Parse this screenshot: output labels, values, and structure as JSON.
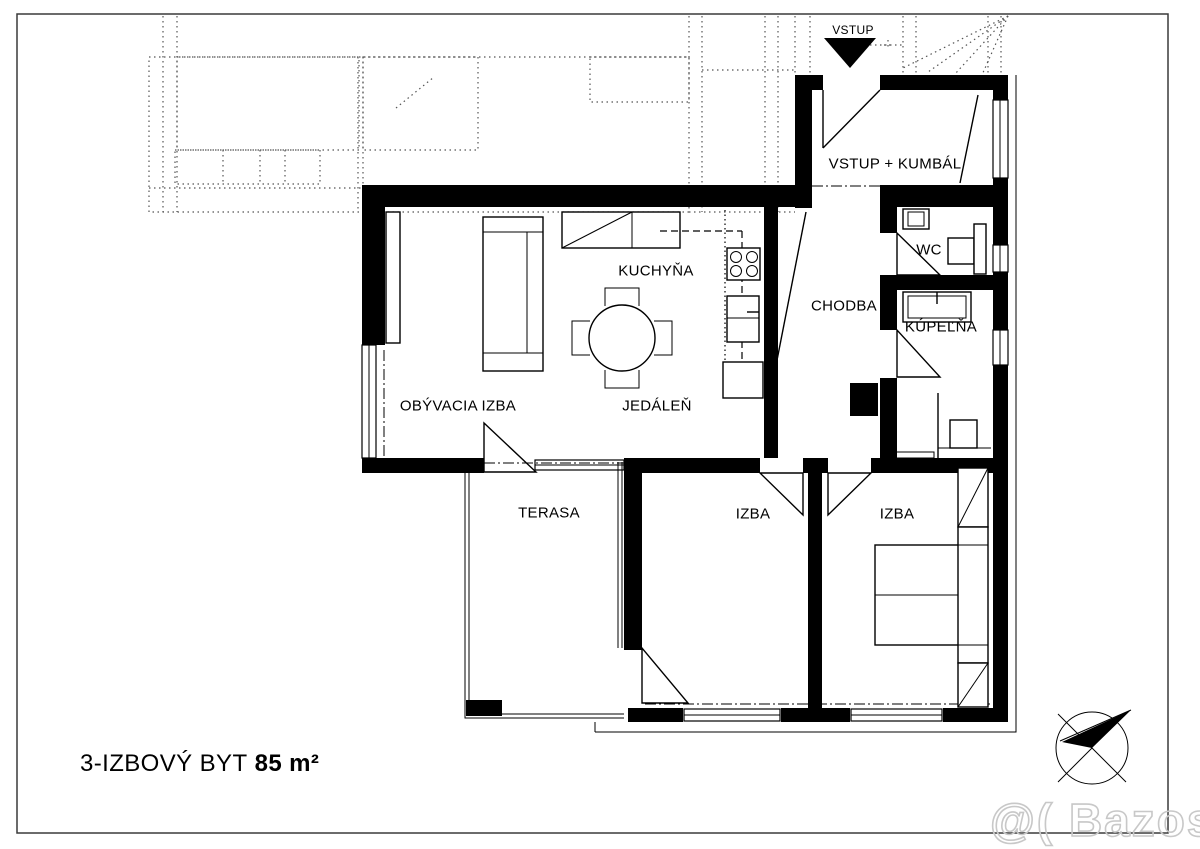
{
  "page": {
    "title_plain": "3-IZBOVÝ BYT",
    "title_bold": "85 m²",
    "watermark": "@( Bazos.sk"
  },
  "entrance": {
    "label": "VSTUP"
  },
  "rooms": {
    "vstup_kumbal": {
      "label": "VSTUP + KUMBÁL"
    },
    "wc": {
      "label": "WC"
    },
    "kupelna": {
      "label": "KÚPEĽŇA"
    },
    "chodba": {
      "label": "CHODBA"
    },
    "kuchyna": {
      "label": "KUCHYŇA"
    },
    "jedalen": {
      "label": "JEDÁLEŇ"
    },
    "obyvacia_izba": {
      "label": "OBÝVACIA IZBA"
    },
    "terasa": {
      "label": "TERASA"
    },
    "izba1": {
      "label": "IZBA"
    },
    "izba2": {
      "label": "IZBA"
    }
  },
  "icons": {
    "entrance_arrow": "filled-down-triangle",
    "compass": "compass-rose-ne-arrow"
  },
  "colors": {
    "ink": "#000000",
    "paper": "#ffffff",
    "neighbor": "#555555",
    "watermark": "#c8c8c8",
    "border": "#3a3a3a"
  }
}
